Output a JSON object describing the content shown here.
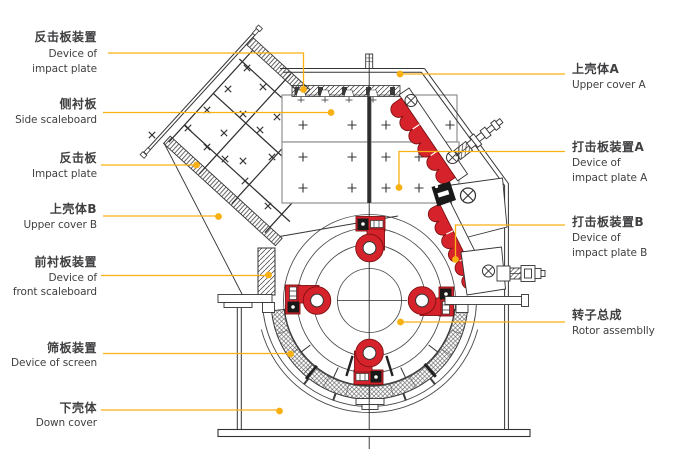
{
  "colors": {
    "callout": "#F9B013",
    "plate_red": "#D6232B",
    "ink": "#333333"
  },
  "labels": {
    "left": [
      {
        "zh": "反击板装置",
        "en": [
          "Device of",
          "impact plate"
        ]
      },
      {
        "zh": "侧衬板",
        "en": [
          "Side scaleboard"
        ]
      },
      {
        "zh": "反击板",
        "en": [
          "Impact plate"
        ]
      },
      {
        "zh": "上壳体B",
        "en": [
          "Upper cover B"
        ]
      },
      {
        "zh": "前衬板装置",
        "en": [
          "Device of",
          "front scaleboard"
        ]
      },
      {
        "zh": "筛板装置",
        "en": [
          "Device of screen"
        ]
      },
      {
        "zh": "下壳体",
        "en": [
          "Down cover"
        ]
      }
    ],
    "right": [
      {
        "zh": "上壳体A",
        "en": [
          "Upper cover A"
        ]
      },
      {
        "zh": "打击板装置A",
        "en": [
          "Device of",
          "impact plate A"
        ]
      },
      {
        "zh": "打击板装置B",
        "en": [
          "Device of",
          "impact plate B"
        ]
      },
      {
        "zh": "转子总成",
        "en": [
          "Rotor assemblly"
        ]
      }
    ]
  }
}
